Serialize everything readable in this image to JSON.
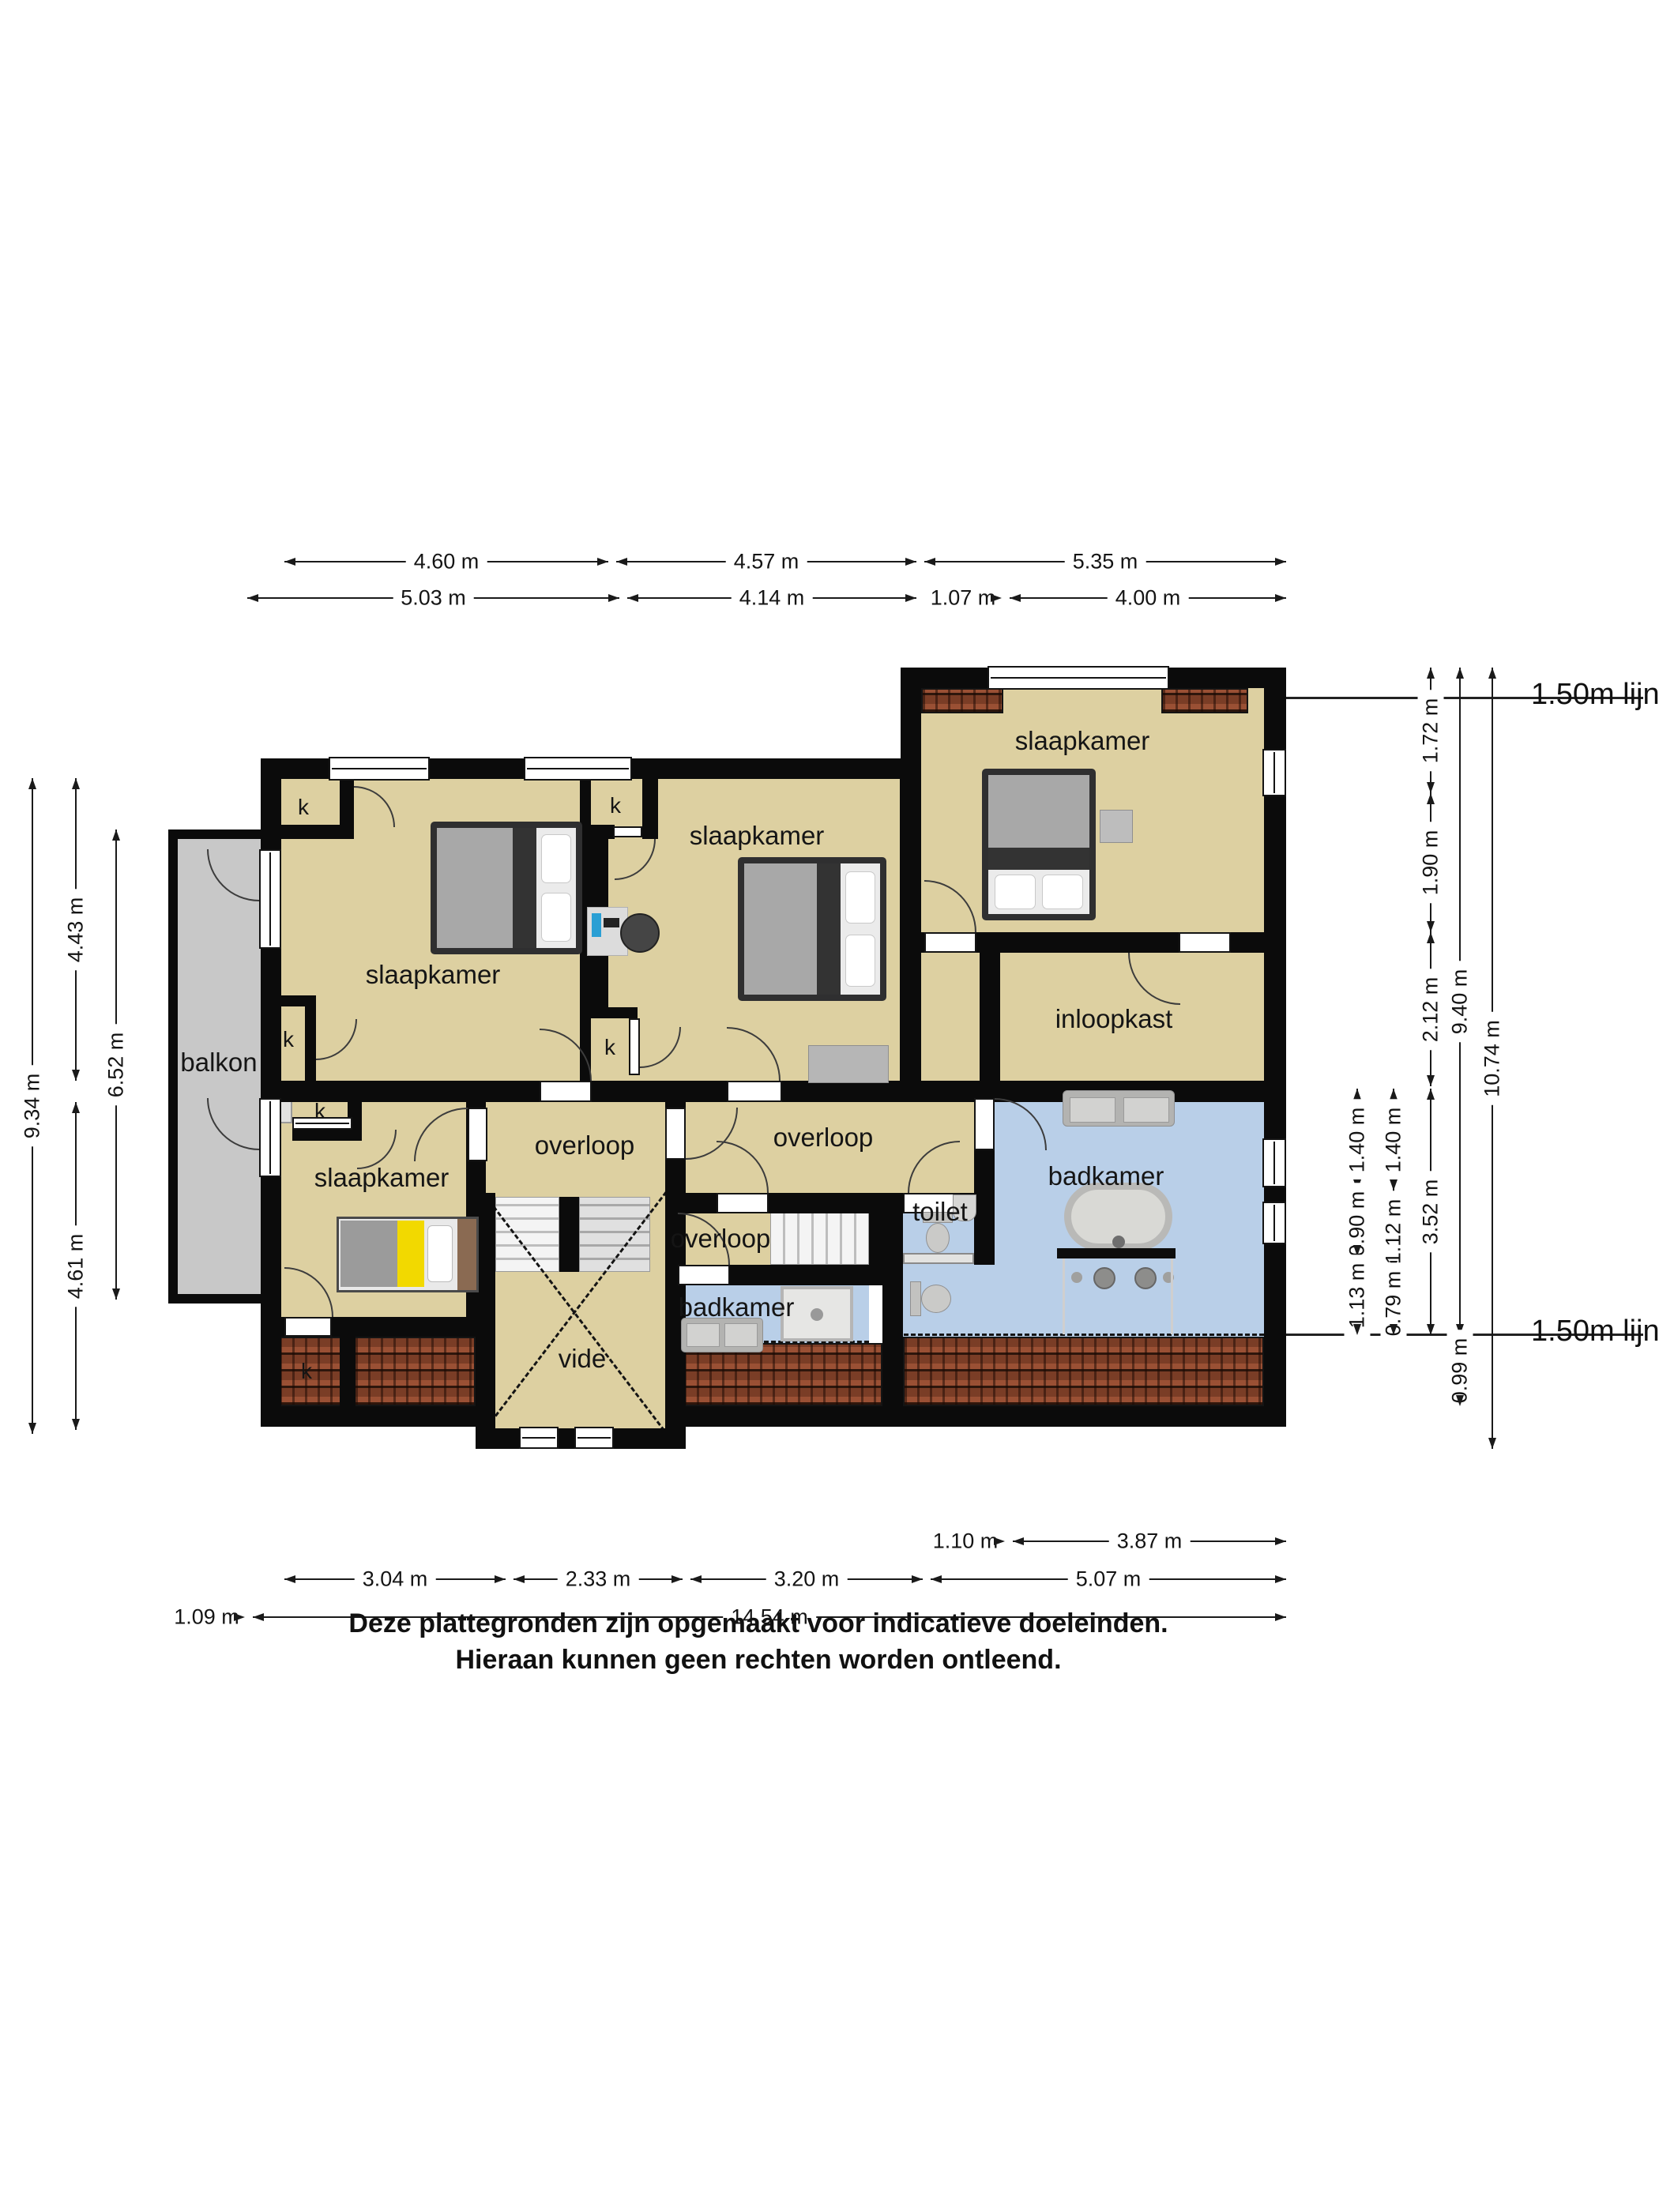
{
  "rooms": {
    "bedroom_top_left": "slaapkamer",
    "bedroom_middle": "slaapkamer",
    "bedroom_top_right": "slaapkamer",
    "bedroom_bottom_left": "slaapkamer",
    "walk_in_closet": "inloopkast",
    "landing_left": "overloop",
    "landing_center": "overloop",
    "landing_small": "overloop",
    "bathroom_main": "badkamer",
    "bathroom_small": "badkamer",
    "toilet": "toilet",
    "void": "vide",
    "balcony": "balkon"
  },
  "closet_label": "k",
  "lijn_label": "1.50m lijn",
  "dimensions": {
    "top_row1": [
      "4.60 m",
      "4.57 m",
      "5.35 m"
    ],
    "top_row2": [
      "5.03 m",
      "4.14 m",
      "1.07 m",
      "4.00 m"
    ],
    "bottom_row0": [
      "1.10 m",
      "3.87 m"
    ],
    "bottom_row1": [
      "3.04 m",
      "2.33 m",
      "3.20 m",
      "5.07 m"
    ],
    "bottom_row2": [
      "1.09 m",
      "14.54 m"
    ],
    "left": [
      "9.34 m",
      "4.43 m",
      "4.61 m",
      "6.52 m"
    ],
    "right": [
      "1.72 m",
      "1.90 m",
      "2.12 m",
      "3.52 m",
      "9.40 m",
      "0.99 m",
      "10.74 m",
      "1.40 m",
      "0.90 m",
      "1.13 m",
      "1.40 m",
      "1.12 m",
      "0.79 m"
    ]
  },
  "disclaimer": {
    "line1": "Deze plattegronden zijn opgemaakt voor indicatieve doeleinden.",
    "line2": "Hieraan kunnen geen rechten worden ontleend."
  },
  "colors": {
    "room_fill": "#ddd0a1",
    "bathroom_fill": "#b9cfe8",
    "balcony_fill": "#c8c8c8",
    "wall": "#0b0b0b",
    "roof_tile": "#9a5034",
    "bed_yellow": "#f2d900"
  }
}
